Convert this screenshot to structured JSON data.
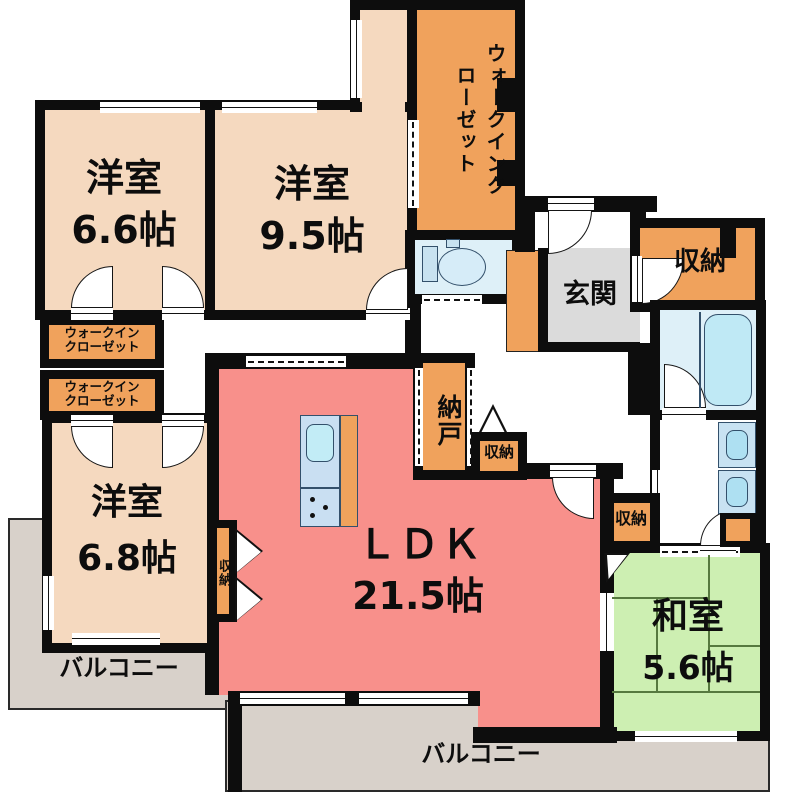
{
  "title": "間取り図",
  "colors": {
    "wall": "#0d0d0d",
    "room_peach": "#F5D9BF",
    "storage_orange": "#F0A25C",
    "ldk_pink": "#F8908B",
    "tatami_green": "#CDEFB2",
    "wet_blue": "#DEF0F8",
    "fixture_blue": "#BFE9F5",
    "genkan_gray": "#DBDBDB",
    "balcony_gray": "#D8D1CA"
  },
  "rooms": {
    "western_66": {
      "name": "洋室",
      "size": "6.6帖"
    },
    "western_95": {
      "name": "洋室",
      "size": "9.5帖"
    },
    "western_68": {
      "name": "洋室",
      "size": "6.8帖"
    },
    "ldk": {
      "name": "ＬＤＫ",
      "size": "21.5帖"
    },
    "japanese": {
      "name": "和室",
      "size": "5.6帖"
    },
    "wic_top": {
      "label": "ウォークインクローゼット"
    },
    "wic_left_1": {
      "label": "ウォークイン\nクローゼット"
    },
    "wic_left_2": {
      "label": "ウォークイン\nクローゼット"
    },
    "nando": {
      "label": "納戸"
    },
    "genkan": {
      "label": "玄関"
    },
    "storage_top_right": {
      "label": "収納"
    },
    "storage_hall": {
      "label": "収納"
    },
    "storage_nando_side": {
      "label": "収納"
    },
    "storage_western_68": {
      "label": "収納"
    },
    "balcony_left": {
      "label": "バルコニー"
    },
    "balcony_bottom": {
      "label": "バルコニー"
    }
  },
  "icons": {
    "toilet": "toilet-icon",
    "bathtub": "bathtub-icon",
    "kitchen_sink": "kitchen-sink-icon",
    "stove": "stove-burner-icon",
    "vanity": "vanity-sink-icon",
    "washer": "washing-machine-icon"
  }
}
